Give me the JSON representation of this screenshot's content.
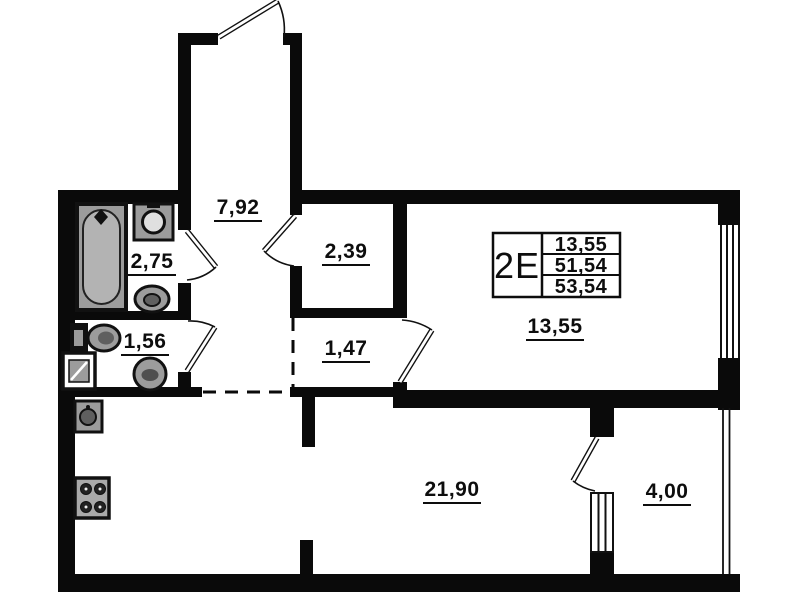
{
  "info_box": {
    "unit_type": "2E",
    "values": [
      "13,55",
      "51,54",
      "53,54"
    ]
  },
  "rooms": [
    {
      "name": "hallway",
      "area": "7,92"
    },
    {
      "name": "bathroom",
      "area": "2,75"
    },
    {
      "name": "closet",
      "area": "2,39"
    },
    {
      "name": "wc",
      "area": "1,56"
    },
    {
      "name": "corridor",
      "area": "1,47"
    },
    {
      "name": "bedroom",
      "area": "13,55"
    },
    {
      "name": "kitchen-living-room",
      "area": "21,90"
    },
    {
      "name": "balcony",
      "area": "4,00"
    }
  ],
  "fixtures": {
    "bathroom": [
      "bathtub",
      "washbasin",
      "toilet"
    ],
    "wc": [
      "toilet",
      "washbasin",
      "appliance-box"
    ],
    "kitchen": [
      "sink",
      "stove-4-burner"
    ]
  },
  "features": {
    "doors": [
      "entrance-door",
      "bathroom-door",
      "wc-door",
      "closet-door",
      "bedroom-door",
      "balcony-door"
    ],
    "windows": [
      "bedroom-window",
      "living-room-window",
      "balcony-glazing"
    ]
  },
  "colors": {
    "walls": "#0a0a0a",
    "fixture_fill": "#9c9c9c",
    "background": "#ffffff"
  }
}
